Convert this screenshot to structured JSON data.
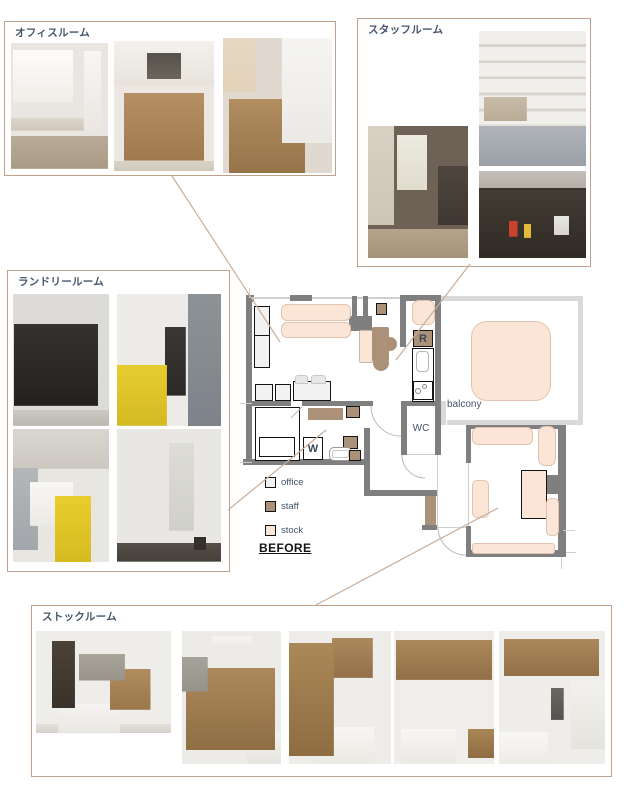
{
  "rooms": {
    "office": {
      "label": "オフィスルーム",
      "photos": [
        "desk-whiteboard-and-drawer-unit",
        "stacked-cardboard-boxes-by-window",
        "white-shelf-and-boxes"
      ]
    },
    "staff": {
      "label": "スタッフルーム",
      "photos": [
        "kitchen-corner-with-window",
        "wall-shelves-with-dishes",
        "under-sink-storage"
      ]
    },
    "laundry": {
      "label": "ランドリールーム",
      "photos": [
        "hanging-coats",
        "lockers-and-yellow-laundry-bag",
        "washbasin-and-yellow-bag",
        "tall-white-cabinet"
      ]
    },
    "stock": {
      "label": "ストックルーム",
      "photos": [
        "room-with-doorway-and-table",
        "cardboard-box-wall",
        "boxes-and-white-table",
        "overhead-shelf-with-boxes",
        "shelf-bins-and-table"
      ]
    }
  },
  "plan": {
    "balcony_label": "balcony",
    "wc_label": "WC",
    "washer_label": "W",
    "fridge_label": "R",
    "legend": {
      "office": "office",
      "staff": "staff",
      "stock": "stock"
    },
    "before_label": "BEFORE",
    "colors": {
      "wall": "#7f7f7f",
      "balcony_rail": "#d9d9d9",
      "office_fill": "#f2f2f2",
      "staff_fill": "#ac9179",
      "stock_fill": "#fbe5d6",
      "connector_line": "#c9ad99",
      "label_text": "#44546A",
      "group_border": "#bda18c"
    }
  }
}
